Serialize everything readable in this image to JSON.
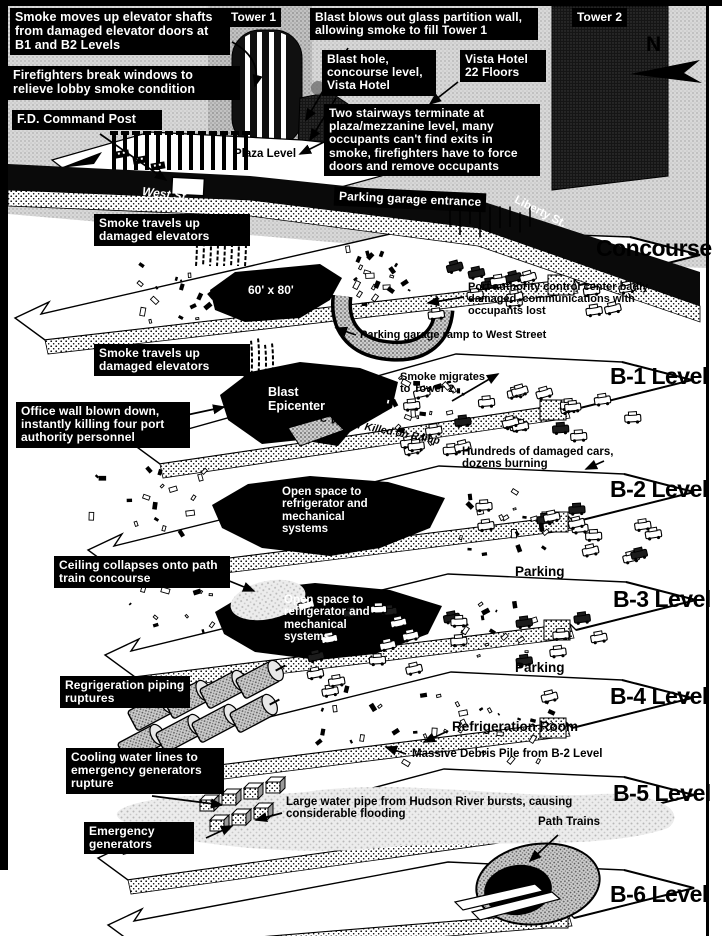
{
  "diagram": {
    "compass_label": "N",
    "levels": [
      "Concourse",
      "B-1 Level",
      "B-2 Level",
      "B-3 Level",
      "B-4 Level",
      "B-5 Level",
      "B-6 Level"
    ],
    "callouts": {
      "smoke_moves": "Smoke moves up elevator shafts from damaged elevator doors at B1 and B2 Levels",
      "firefighters": "Firefighters break windows to relieve lobby smoke condition",
      "fd_command_post": "F.D. Command Post",
      "tower1": "Tower 1",
      "blast_blows": "Blast blows out glass partition wall, allowing smoke to fill Tower 1",
      "blast_hole": "Blast hole, concourse level, Vista Hotel",
      "vista_hotel": "Vista Hotel 22 Floors",
      "tower2": "Tower 2",
      "two_stairways": "Two stairways terminate at plaza/mezzanine level, many occupants can't find exits in smoke, firefighters have to force doors and remove occupants",
      "parking_garage_entrance": "Parking garage entrance",
      "smoke_travels_1": "Smoke travels up damaged elevators",
      "smoke_travels_2": "Smoke travels up damaged elevators",
      "office_wall": "Office wall blown down, instantly killing four port authority personnel",
      "ceiling_collapses": "Ceiling collapses onto path train concourse",
      "refrigeration_piping": "Regrigeration piping ruptures",
      "cooling_water": "Cooling water lines to emergency generators rupture",
      "emergency_generators": "Emergency generators"
    },
    "street_labels": {
      "plaza_level": "Plaza Level",
      "west_st": "West St.",
      "liberty_st": "Liberty St."
    },
    "scene_labels": {
      "blast_dimensions": "60' x 80'",
      "port_authority": "Port authority control center badly damaged, communications with occupants lost",
      "garage_ramp": "Parking garage ramp to West Street",
      "blast_epicenter": "Blast Epicenter",
      "smoke_migrates": "Smoke migrates to Tower 2",
      "wtc_visitor": "WTC Visitor Killed on Ramp",
      "hundreds_cars": "Hundreds of damaged cars, dozens burning",
      "open_space_b2": "Open space to refrigerator and mechanical systems",
      "open_space_b3": "Open space to refrigerator and mechanical systems",
      "parking_1": "Parking",
      "parking_2": "Parking",
      "refrigeration_room": "Refrigeration Room",
      "massive_debris": "Massive Debris Pile from B-2 Level",
      "water_pipe": "Large water pipe from Hudson River bursts, causing considerable flooding",
      "path_trains": "Path Trains"
    },
    "colors": {
      "ink": "#000000",
      "paper": "#ffffff",
      "halftone": "#d6d6d6"
    }
  }
}
